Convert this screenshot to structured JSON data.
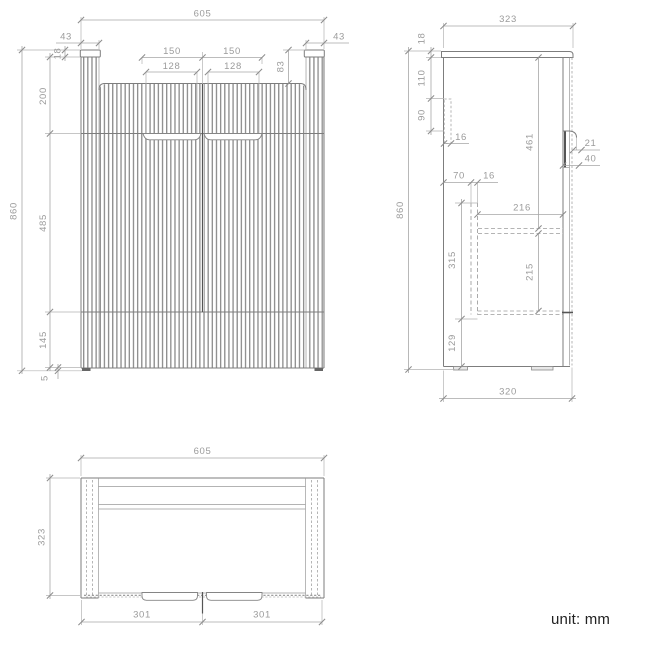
{
  "front_view": {
    "dims": {
      "overall_width": "605",
      "cap_left": "43",
      "cap_right": "43",
      "cap_height": "18",
      "top_to_handles": "200",
      "recess_left": "150",
      "recess_right": "150",
      "groove_left": "128",
      "groove_right": "128",
      "top_panel": "83",
      "door_section": "485",
      "drawer_section": "145",
      "feet_height": "5",
      "overall_height": "860"
    }
  },
  "side_view": {
    "dims": {
      "overall_depth": "323",
      "top_thickness": "18",
      "bracket_offset": "110",
      "bracket_length": "90",
      "bracket_width": "16",
      "front_opening": "461",
      "handle_lip": "21",
      "handle_recess": "40",
      "rail_offset": "70",
      "rail_width": "16",
      "interior_depth": "216",
      "drawer_box": "315",
      "lower_opening": "215",
      "bottom_section": "129",
      "overall_height": "860",
      "base_depth": "320"
    }
  },
  "top_view": {
    "dims": {
      "overall_width": "605",
      "overall_depth": "323",
      "door_left": "301",
      "door_right": "301"
    }
  },
  "footer": {
    "unit_label": "unit: mm"
  }
}
